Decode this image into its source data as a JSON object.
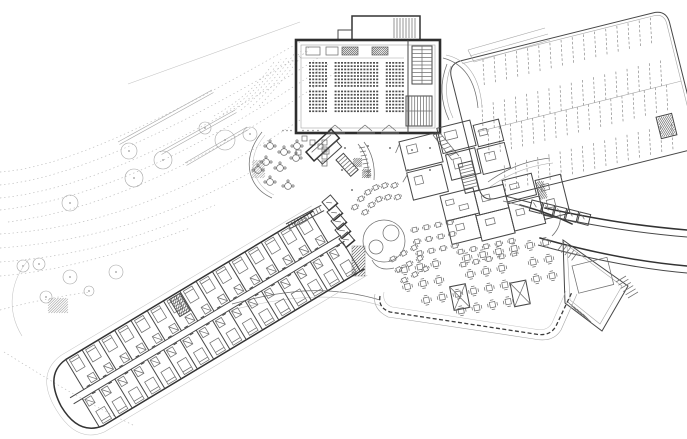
{
  "meta": {
    "drawing_type": "architectural site / ground floor plan",
    "canvas": {
      "width": 687,
      "height": 439
    },
    "colors": {
      "background": "#ffffff",
      "heavy_wall": "#2e2e2e",
      "wall": "#333333",
      "medium_line": "#707070",
      "light_line": "#a6a6a6",
      "site_line": "#c4c4c4",
      "seat_fill": "#4f4f4f"
    }
  },
  "zones": {
    "site": {
      "trees": [
        [
          225,
          140,
          10
        ],
        [
          163,
          160,
          9
        ],
        [
          129,
          151,
          8
        ],
        [
          134,
          178,
          9
        ],
        [
          70,
          203,
          8
        ],
        [
          250,
          134,
          7
        ],
        [
          205,
          128,
          6
        ],
        [
          23,
          266,
          6
        ],
        [
          39,
          264,
          6
        ],
        [
          70,
          277,
          7
        ],
        [
          116,
          272,
          7
        ],
        [
          46,
          297,
          6
        ],
        [
          89,
          291,
          5
        ]
      ],
      "contour_count": 9,
      "retaining_walls": [
        [
          118,
          142,
          212,
          90
        ],
        [
          160,
          152,
          235,
          110
        ],
        [
          185,
          163,
          247,
          127
        ]
      ]
    },
    "auditorium": {
      "seats": {
        "rows": 15,
        "cols": 30,
        "aisle_cols": [
          6,
          7,
          22,
          23
        ],
        "gap_after_row": 7,
        "col_w": 3.2,
        "row_h": 3.3
      },
      "entry_doors": 3,
      "balcony_boxes": 4
    },
    "parking": {
      "angle": -14,
      "stall_step": 11.5,
      "stall_slant": 5,
      "rows": [
        {
          "y1": 4,
          "y2": 30,
          "x0": 30,
          "n": 16
        },
        {
          "y1": 48,
          "y2": 73,
          "x0": 18,
          "n": 17
        },
        {
          "y1": 73,
          "y2": 98,
          "x0": 18,
          "n": 17
        },
        {
          "y1": 112,
          "y2": 138,
          "x0": 25,
          "n": 16
        }
      ]
    },
    "hotel_wing": {
      "angle": -31,
      "rooms_top": 15,
      "rooms_bottom": 16,
      "room_w": 19
    },
    "cafe": {
      "round_tables": [
        [
          270,
          146
        ],
        [
          284,
          152
        ],
        [
          266,
          162
        ],
        [
          280,
          168
        ],
        [
          270,
          182
        ],
        [
          288,
          186
        ],
        [
          296,
          158
        ],
        [
          258,
          170
        ],
        [
          297,
          146
        ]
      ],
      "square_tables": [
        [
          302,
          136
        ],
        [
          310,
          140
        ],
        [
          318,
          144
        ],
        [
          324,
          149
        ],
        [
          296,
          150
        ]
      ]
    },
    "lounge": {
      "circle": [
        384,
        241,
        21
      ],
      "inner_circles": [
        [
          376,
          247,
          7
        ],
        [
          391,
          233,
          8
        ]
      ],
      "table_clusters": [
        {
          "x": 352,
          "y": 206,
          "rot": -25,
          "pts": [
            [
              0,
              0
            ],
            [
              9,
              -5
            ],
            [
              18,
              -8
            ],
            [
              27,
              -9
            ],
            [
              36,
              -7
            ],
            [
              45,
              -3
            ],
            [
              7,
              9
            ],
            [
              16,
              5
            ],
            [
              25,
              3
            ],
            [
              34,
              5
            ],
            [
              43,
              9
            ]
          ]
        },
        {
          "x": 412,
          "y": 228,
          "rot": -12,
          "grid": [
            4,
            3
          ],
          "step": 12
        },
        {
          "x": 458,
          "y": 250,
          "rot": -12,
          "grid": [
            5,
            2
          ],
          "step": 13
        },
        {
          "x": 390,
          "y": 258,
          "rot": -28,
          "grid": [
            3,
            3
          ],
          "step": 12
        }
      ],
      "column_dots": [
        [
          345,
          148
        ],
        [
          368,
          146
        ],
        [
          390,
          148
        ],
        [
          342,
          170
        ],
        [
          412,
          150
        ],
        [
          408,
          170
        ],
        [
          430,
          148
        ],
        [
          352,
          190
        ],
        [
          430,
          170
        ]
      ]
    },
    "dining": {
      "angle": -11,
      "table_step": 16,
      "rows": [
        {
          "y": 16,
          "x0": 0,
          "n": 10,
          "skip": [
            3
          ]
        },
        {
          "y": 33,
          "x0": 0,
          "n": 10,
          "skip": [
            3,
            7
          ]
        },
        {
          "y": 50,
          "x0": 16,
          "n": 9,
          "skip": [
            6
          ]
        },
        {
          "y": 67,
          "x0": 48,
          "n": 4,
          "skip": []
        }
      ],
      "service_stations": [
        [
          44,
          44
        ],
        [
          104,
          52
        ]
      ]
    },
    "right_wing": {
      "room_count": 5
    },
    "connector": {
      "room_count": 5,
      "escalator_ticks": 11
    }
  }
}
